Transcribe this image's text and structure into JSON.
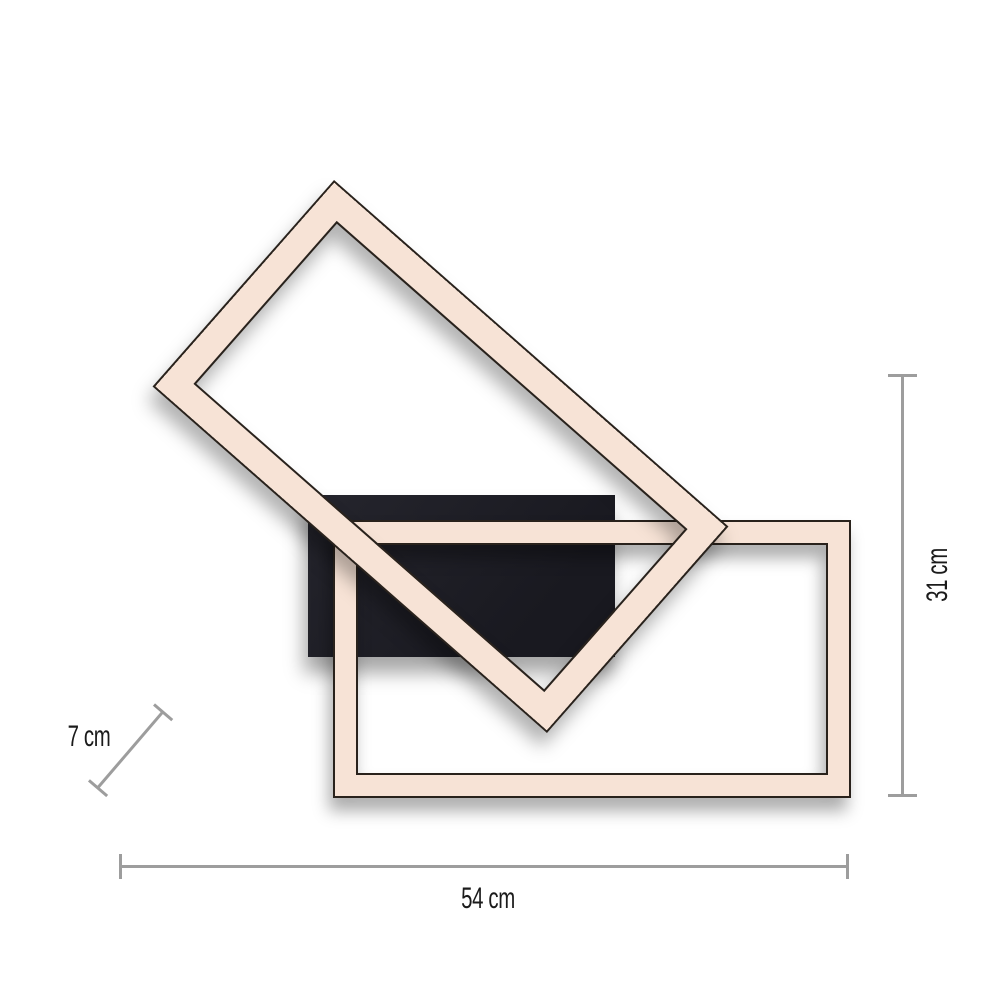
{
  "diagram": {
    "kind": "product-dimension-diagram",
    "parts": [
      "rotated-led-frame",
      "horizontal-led-frame",
      "mounting-plate"
    ]
  },
  "dimensions": {
    "width": {
      "label": "54 cm"
    },
    "height": {
      "label": "31 cm"
    },
    "depth": {
      "label": "7 cm"
    }
  },
  "colors": {
    "background": "#ffffff",
    "frame-fill": "#f7e3d6",
    "frame-outline": "#29221c",
    "plate": "#25252d",
    "plate-dark": "#191920",
    "dim-line": "#9d9d9d",
    "text": "#1b1b1b"
  }
}
